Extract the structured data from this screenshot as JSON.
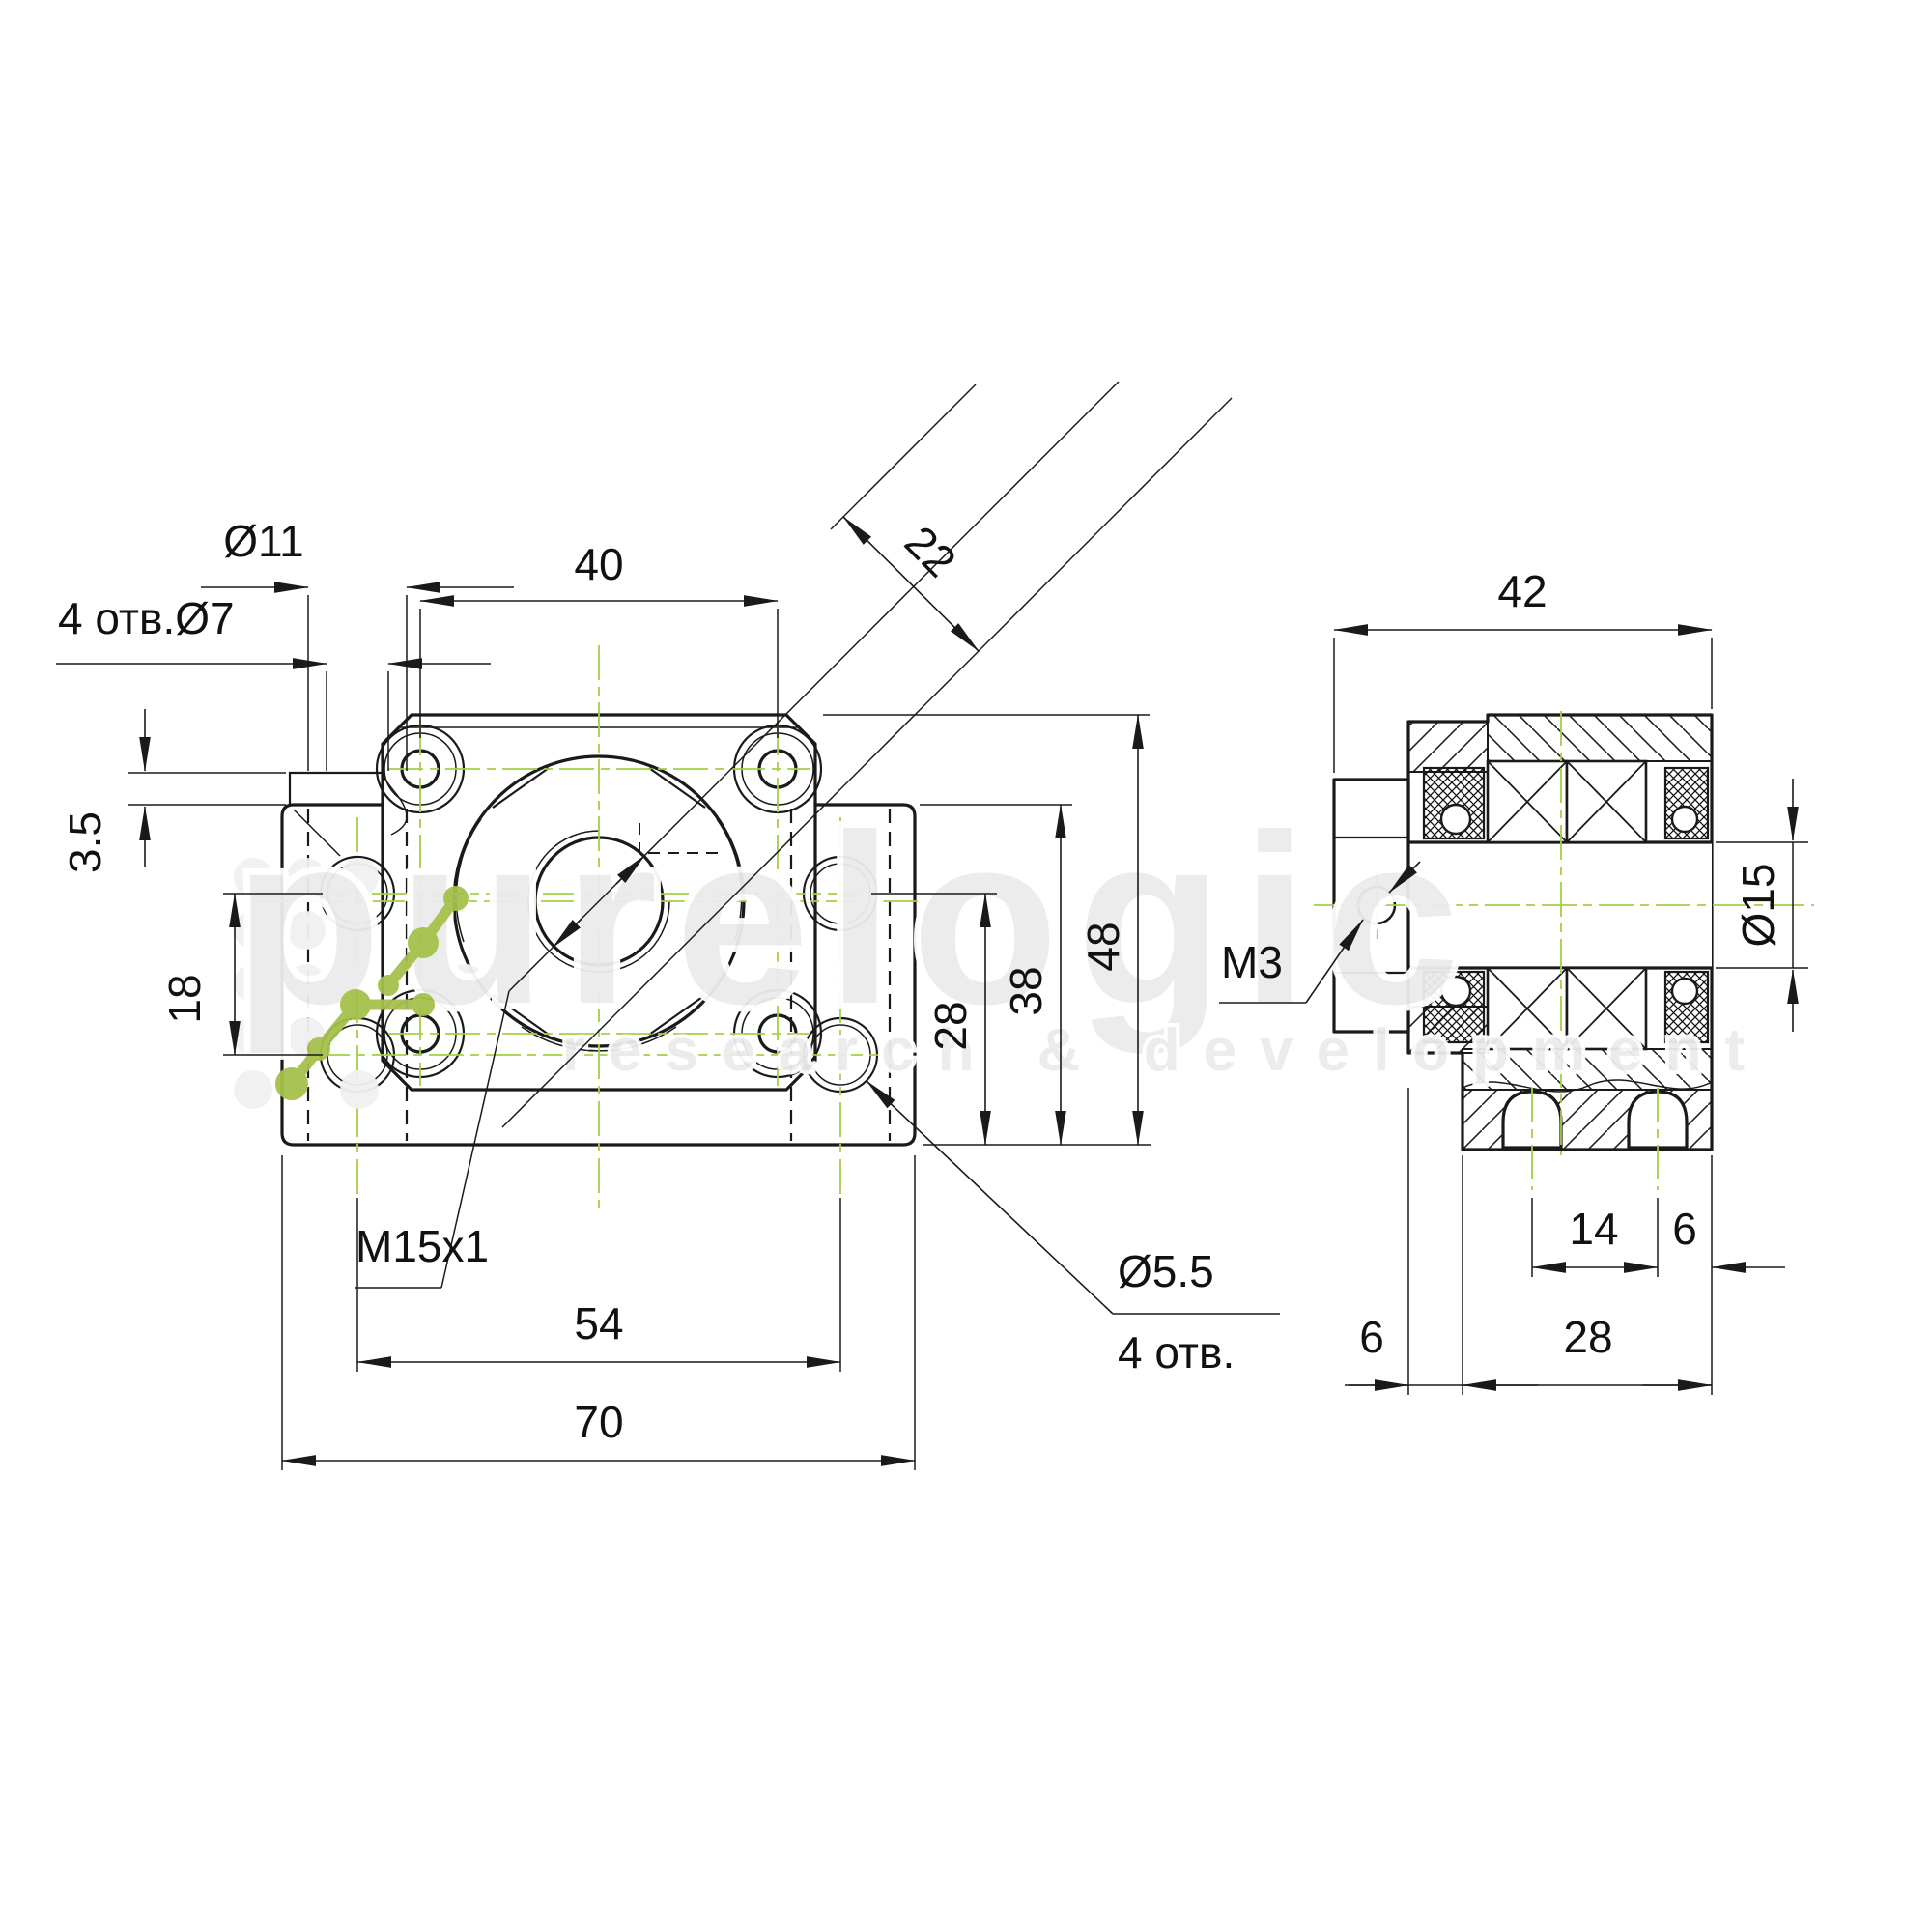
{
  "front": {
    "d11": "Ø11",
    "holes7": "4 отв.Ø7",
    "d40": "40",
    "d22": "22",
    "d35": "3.5",
    "d18": "18",
    "m15": "M15x1",
    "d55": "Ø5.5",
    "holes4": "4 отв.",
    "d54": "54",
    "d70": "70",
    "d28": "28",
    "d38": "38",
    "d48": "48"
  },
  "side": {
    "d42": "42",
    "d15": "Ø15",
    "m3": "M3",
    "d14": "14",
    "d6_right": "6",
    "d6_left": "6",
    "d28": "28"
  },
  "watermark": {
    "brand": "purelogic",
    "tagline": "research & development"
  },
  "colors": {
    "centerline_green": "#a2cf45",
    "drawing_line": "#1a1a1a",
    "watermark_gray": "#ececec",
    "logo_green": "#a5c14b"
  }
}
